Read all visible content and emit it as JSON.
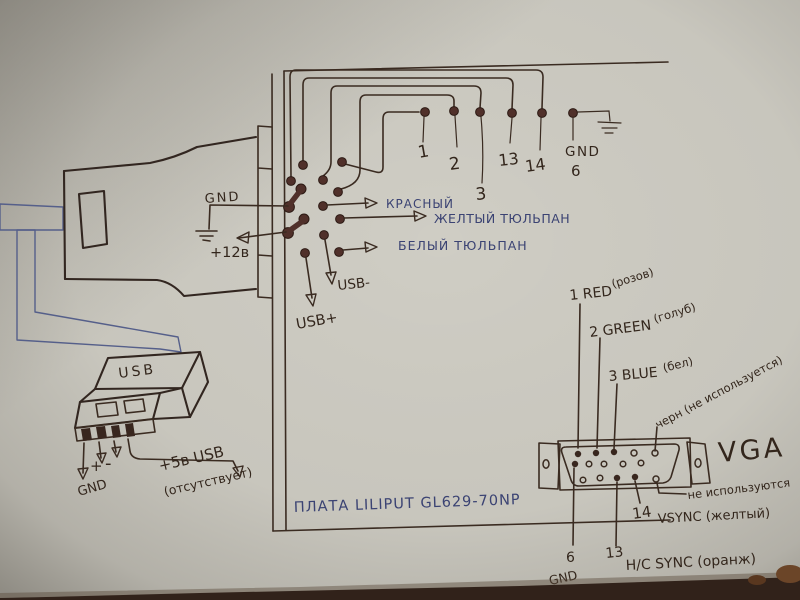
{
  "board": {
    "title": "ПЛАТА LILIPUT GL629-70NP",
    "power": {
      "gnd": "GND",
      "v12": "+12в"
    },
    "usb_pads": {
      "minus": "USB-",
      "plus": "USB+"
    },
    "rca_outputs": {
      "red": "КРАСНЫЙ",
      "yellow": "ЖЕЛТЫЙ ТЮЛЬПАН",
      "white": "БЕЛЫЙ ТЮЛЬПАН"
    },
    "top_pins": {
      "p1": "1",
      "p2": "2",
      "p3": "3",
      "p13": "13",
      "p14": "14",
      "gnd": "GND",
      "p6": "6"
    }
  },
  "usb_plug": {
    "label": "USB",
    "gnd": "GND",
    "plus": "+",
    "minus": "-",
    "v5": "+5в USB",
    "v5_note": "(отсутствует)"
  },
  "vga": {
    "title": "VGA",
    "red": "1 RED",
    "red_wire": "(розов)",
    "green": "2 GREEN",
    "green_wire": "(голуб)",
    "blue": "3 BLUE",
    "blue_wire": "(бел)",
    "black_wire": "черн (не используется)",
    "unused": "не используются",
    "p14": "14",
    "p14_signal": "VSYNC (желтый)",
    "p13": "13",
    "p13_signal": "H/C SYNC (оранж)",
    "p6": "6",
    "p6_signal": "GND"
  }
}
